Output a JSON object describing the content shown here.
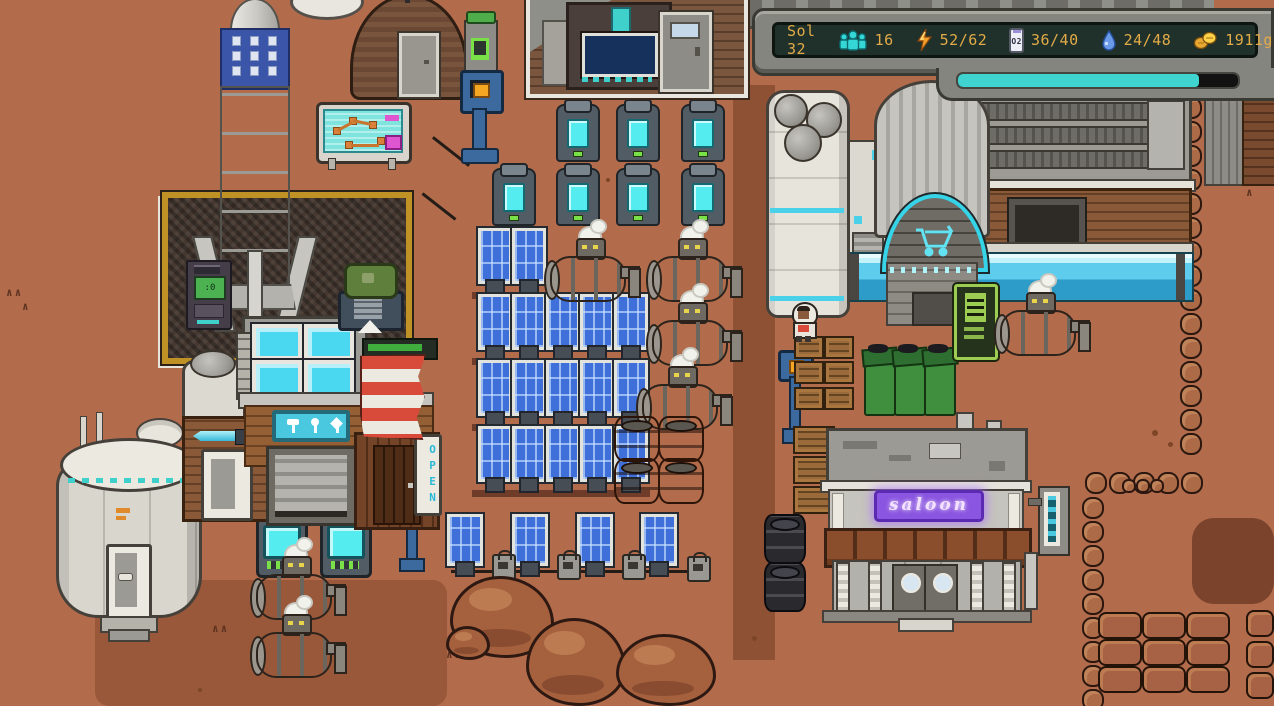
{
  "hud": {
    "sol_label": "Sol 32",
    "stats": [
      {
        "name": "colonists",
        "icon": "colonists-icon",
        "value": "16"
      },
      {
        "name": "power",
        "icon": "power-icon",
        "value": "52/62"
      },
      {
        "name": "oxygen",
        "icon": "oxygen-icon",
        "icon_label": "O2",
        "value": "36/40"
      },
      {
        "name": "water",
        "icon": "water-icon",
        "value": "24/48"
      },
      {
        "name": "credits",
        "icon": "credits-icon",
        "value": "1911g"
      }
    ],
    "day_progress_percent": 86
  },
  "world": {
    "saloon_sign_text": "saloon",
    "open_sign_text": "OPEN"
  },
  "colors": {
    "hud_text": "#e2ab47",
    "hud_panel": "#20302a",
    "progress_fill": "#3fd4cf",
    "terrain": "#b26c4c",
    "road": "#8e5134",
    "accent_cyan": "#4ac8e0",
    "neon_sign": "#8a55e0",
    "solar_blue": "#3f6fd8",
    "launchpad_trim": "#c09124"
  }
}
